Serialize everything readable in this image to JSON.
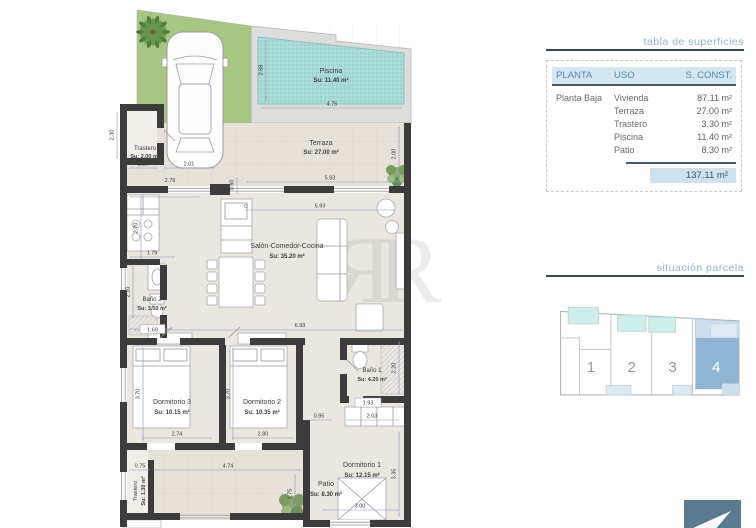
{
  "watermark": "ЯR",
  "colors": {
    "accent_blue": "#8db5d3",
    "rule_dark": "#3c4a57",
    "header_bg": "#d3e6f3",
    "header_text": "#5d87ac",
    "total_bg": "#cde2f1",
    "pool": "#a7dad4",
    "grass": "#a6c77f",
    "wall": "#3c3c3c",
    "parcel_highlight": "#8fb5d5",
    "logo_bg": "#5a7b8f"
  },
  "icons": {
    "logo": "paper-plane-icon"
  },
  "plan": {
    "rooms": {
      "piscina": {
        "name": "Piscina",
        "area": "Su: 11.40 m²"
      },
      "terraza": {
        "name": "Terraza",
        "area": "Su: 27.00 m²"
      },
      "trastero1": {
        "name": "Trastero",
        "area": "Su: 2.00 m²"
      },
      "salon": {
        "name": "Salón-Comedor-Cocina",
        "area": "Su: 35.20 m²"
      },
      "bano2": {
        "name": "Baño 2",
        "area": "Su: 3.50 m²"
      },
      "dorm3": {
        "name": "Dormitorio 3",
        "area": "Su: 10.15 m²"
      },
      "dorm2": {
        "name": "Dormitorio 2",
        "area": "Su: 10.35 m²"
      },
      "bano1": {
        "name": "Baño 1",
        "area": "Su: 4.20 m²"
      },
      "dorm1": {
        "name": "Dormitorio 1",
        "area": "Su: 12.15 m²"
      },
      "patio": {
        "name": "Patio",
        "area": "Su: 8.30 m²"
      },
      "trastero2": {
        "name": "Trastero",
        "area": "Su: 1.30 m²"
      }
    },
    "dims": {
      "pool_w": "4.75",
      "pool_h": "2.68",
      "terr_w": "5.93",
      "terr_h": "2.00",
      "tras_h": "2.30",
      "tras_w1": "1.10",
      "tras_w2": "2.01",
      "kitchen_top": "2.79",
      "step": "0.60",
      "salon_w": "5.93",
      "kitchen_h": "2.70",
      "bano2_top": "1.79",
      "bano2_h": "2.10",
      "bano2_w": "1.69",
      "hall": "6.93",
      "d3_h": "3.70",
      "d2_h": "3.70",
      "d3_w": "2.74",
      "d2_w": "2.80",
      "b1_h": "2.20",
      "b1_w": "1.93",
      "pass": "0.95",
      "closet": "2.03",
      "d1_h": "3.35",
      "d1_w": "3.00",
      "patio_l": "0.75",
      "patio_w": "4.74",
      "patio_h": "1.75"
    }
  },
  "panel": {
    "surfaces_title": "tabla de superficies",
    "table": {
      "headers": [
        "PLANTA",
        "USO",
        "S. CONST."
      ],
      "rows": [
        {
          "planta": "Planta Baja",
          "uso": "Vivienda",
          "sconst": "87.11 m²"
        },
        {
          "planta": "",
          "uso": "Terraza",
          "sconst": "27.00 m²"
        },
        {
          "planta": "",
          "uso": "Trastero",
          "sconst": "3.30 m²"
        },
        {
          "planta": "",
          "uso": "Piscina",
          "sconst": "11.40 m²"
        },
        {
          "planta": "",
          "uso": "Patio",
          "sconst": "8.30 m²"
        }
      ],
      "total": "137.11 m²"
    },
    "parcel_title": "situación parcela",
    "parcels": [
      "1",
      "2",
      "3",
      "4"
    ],
    "highlighted": "4"
  }
}
